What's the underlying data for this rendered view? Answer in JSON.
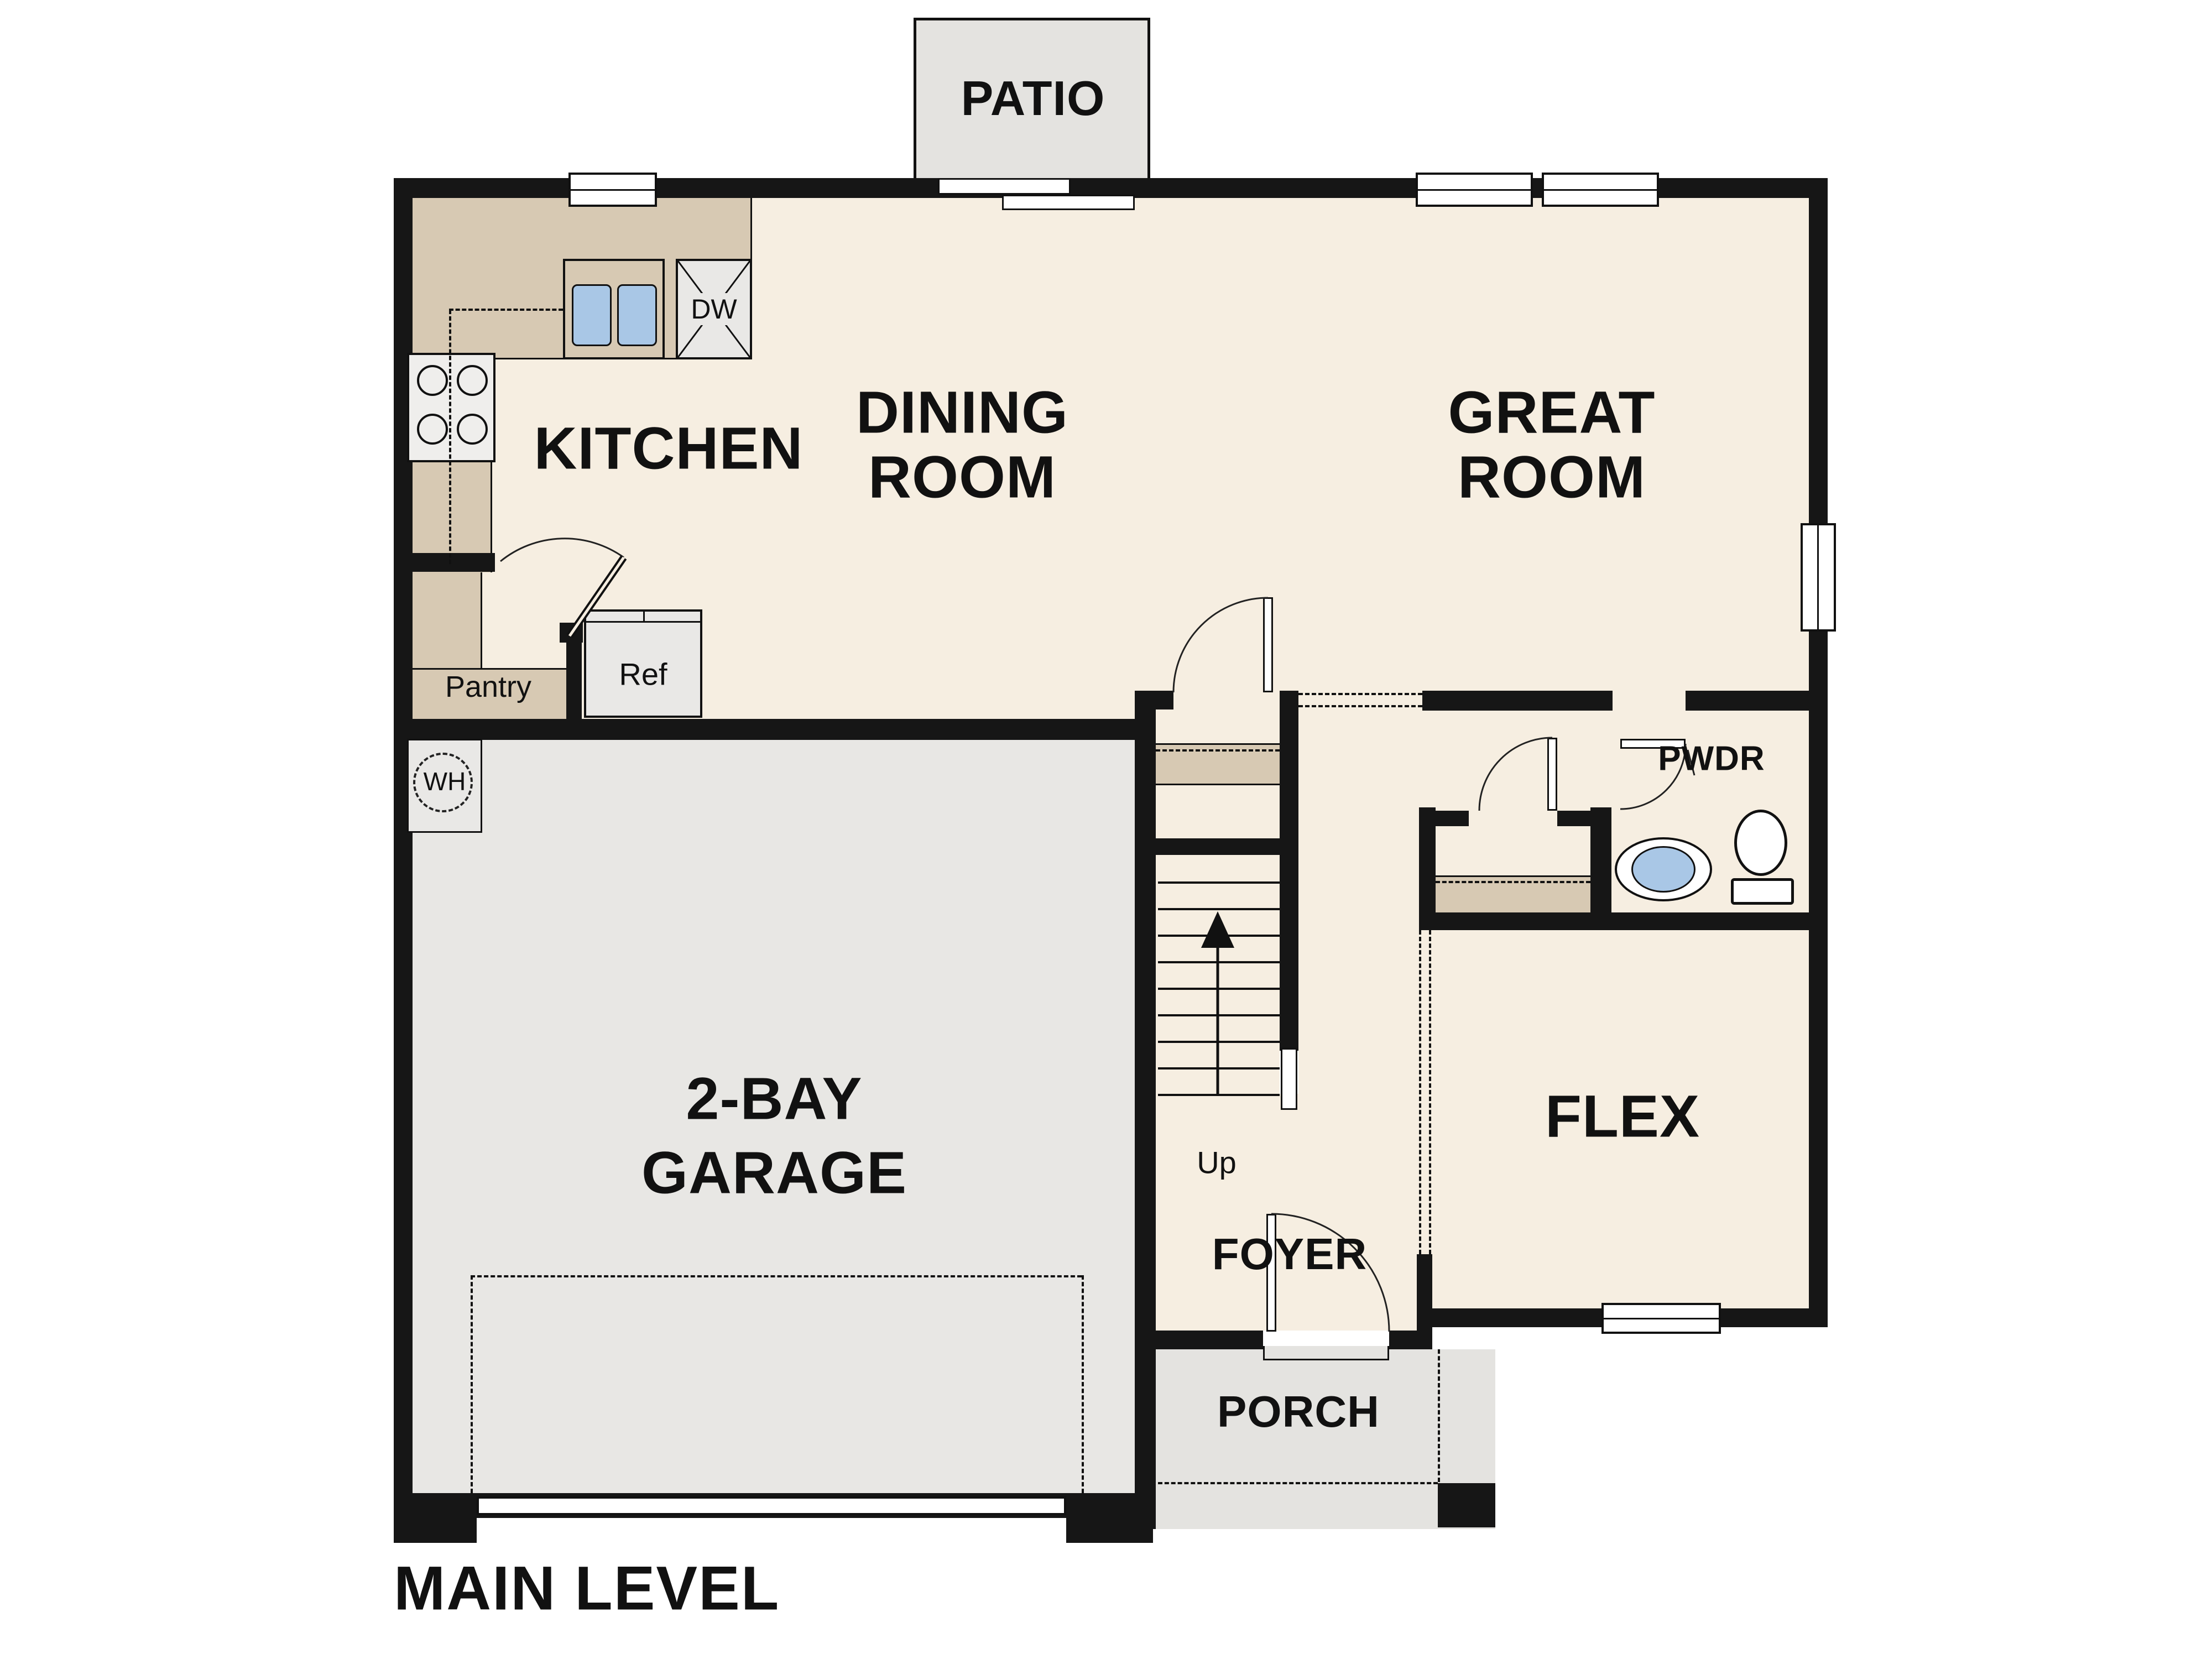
{
  "page": {
    "title": "MAIN LEVEL"
  },
  "rooms": {
    "patio": "PATIO",
    "kitchen": "KITCHEN",
    "dining_l1": "DINING",
    "dining_l2": "ROOM",
    "great_l1": "GREAT",
    "great_l2": "ROOM",
    "garage_l1": "2-BAY",
    "garage_l2": "GARAGE",
    "flex": "FLEX",
    "foyer": "FOYER",
    "porch": "PORCH",
    "pwdr": "PWDR",
    "pantry": "Pantry"
  },
  "fixtures": {
    "refrigerator": "Ref",
    "dishwasher": "DW",
    "water_heater": "WH",
    "stairs_direction": "Up"
  },
  "colors": {
    "wall": "#161616",
    "floor": "#f6eee1",
    "counter": "#d7c9b3",
    "garage_floor": "#e8e7e4",
    "patio_porch": "#e4e3e0",
    "fixture": "#e9e8e6",
    "sink_blue": "#a9c7e6",
    "background": "#ffffff"
  }
}
